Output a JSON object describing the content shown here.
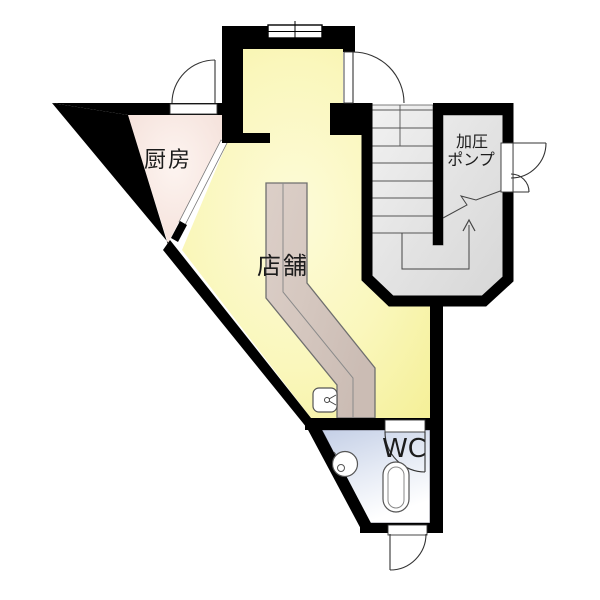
{
  "drawing": {
    "type": "architectural floor plan",
    "rooms": {
      "kitchen": {
        "label": "厨房"
      },
      "shop": {
        "label": "店舗"
      },
      "pump_room": {
        "label_line1": "加圧",
        "label_line2": "ポンプ"
      },
      "wc": {
        "label": "WC"
      },
      "stairs": {
        "steps": 9,
        "direction": "up"
      }
    },
    "fixtures": [
      "counter",
      "counter-sink",
      "corner-hand-basin",
      "toilet",
      "window",
      "hinged-doors"
    ],
    "colors": {
      "wall": "#000000",
      "shop_fill": "#f7f3a2",
      "kitchen_fill": "#f5e0da",
      "stair_fill": "#dedede",
      "wc_fill": "#c7d1e6",
      "counter_fill": "#d5c7bf",
      "line": "#333333"
    }
  }
}
